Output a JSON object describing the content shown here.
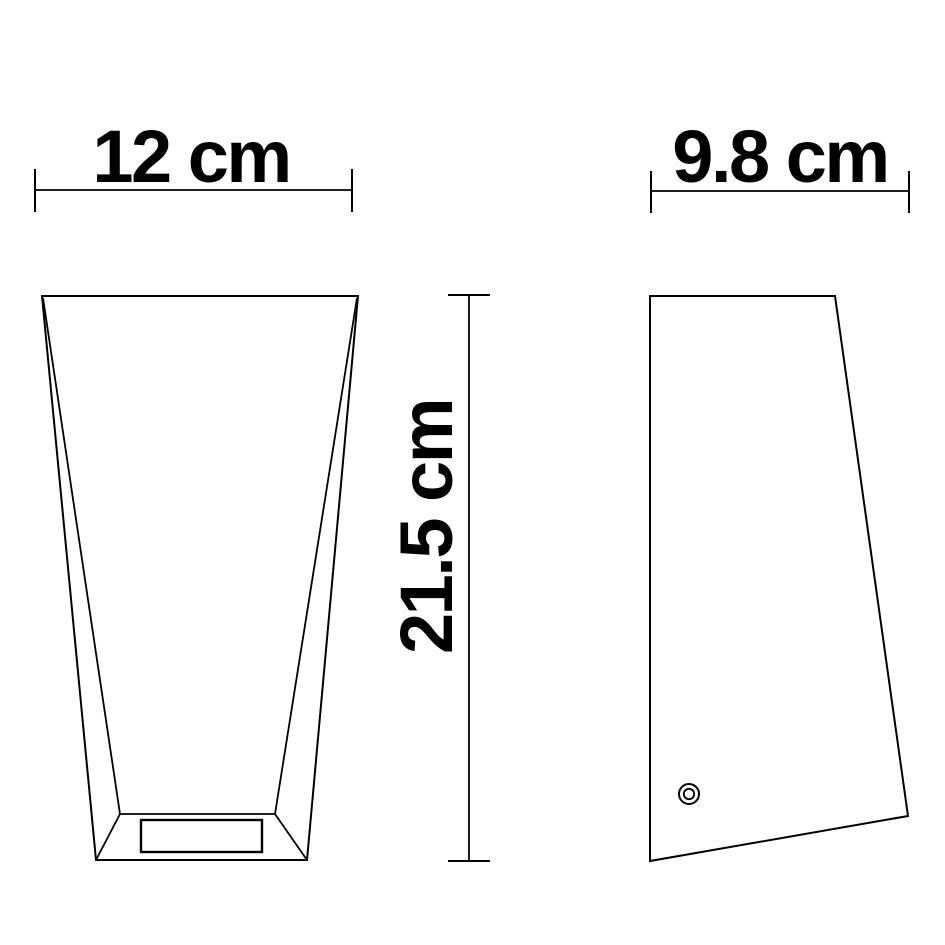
{
  "diagram": {
    "kind": "product-dimension-drawing",
    "background_color": "#ffffff",
    "line_color": "#000000",
    "text_color": "#000000",
    "dimensions": {
      "width_label": "12 cm",
      "depth_label": "9.8 cm",
      "height_label": "21.5 cm"
    },
    "views": {
      "front": {
        "name": "front view",
        "features": [
          "tapered body wider at top",
          "recessed rectangular opening in base"
        ]
      },
      "side": {
        "name": "side view",
        "features": [
          "flat vertical back",
          "front face sloping outward toward base",
          "screw hole near bottom left"
        ]
      }
    }
  }
}
